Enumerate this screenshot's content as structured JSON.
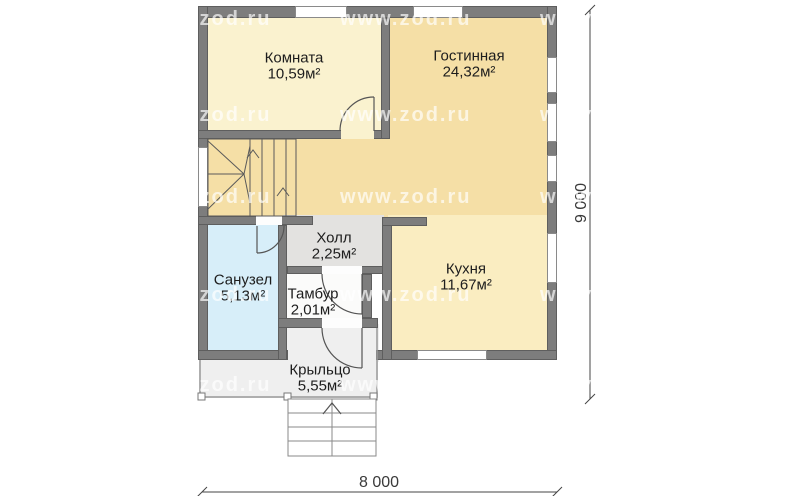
{
  "watermark": {
    "text": "www.zod.ru"
  },
  "rooms": [
    {
      "id": "komnata",
      "name": "Комната",
      "area": "10,59м²"
    },
    {
      "id": "gostinnaya",
      "name": "Гостинная",
      "area": "24,32м²"
    },
    {
      "id": "kholl",
      "name": "Холл",
      "area": "2,25м²"
    },
    {
      "id": "sanuzel",
      "name": "Санузел",
      "area": "5,13м²"
    },
    {
      "id": "tambur",
      "name": "Тамбур",
      "area": "2,01м²"
    },
    {
      "id": "kukhnya",
      "name": "Кухня",
      "area": "11,67м²"
    },
    {
      "id": "kryltso",
      "name": "Крыльцо",
      "area": "5,55м²"
    }
  ],
  "dimensions": {
    "width_label": "8 000",
    "height_label": "9 000"
  },
  "colors": {
    "wall": "#7d7d7d",
    "floor_living_corridor": "#F5DFA6",
    "floor_bedroom": "#FAF2CF",
    "floor_kitchen": "#FAEDC1",
    "floor_bathroom": "#D7EEF9",
    "floor_hall": "#E3E2E0",
    "floor_tambour": "#FBFBFA",
    "floor_porch": "#EFEFEF"
  }
}
